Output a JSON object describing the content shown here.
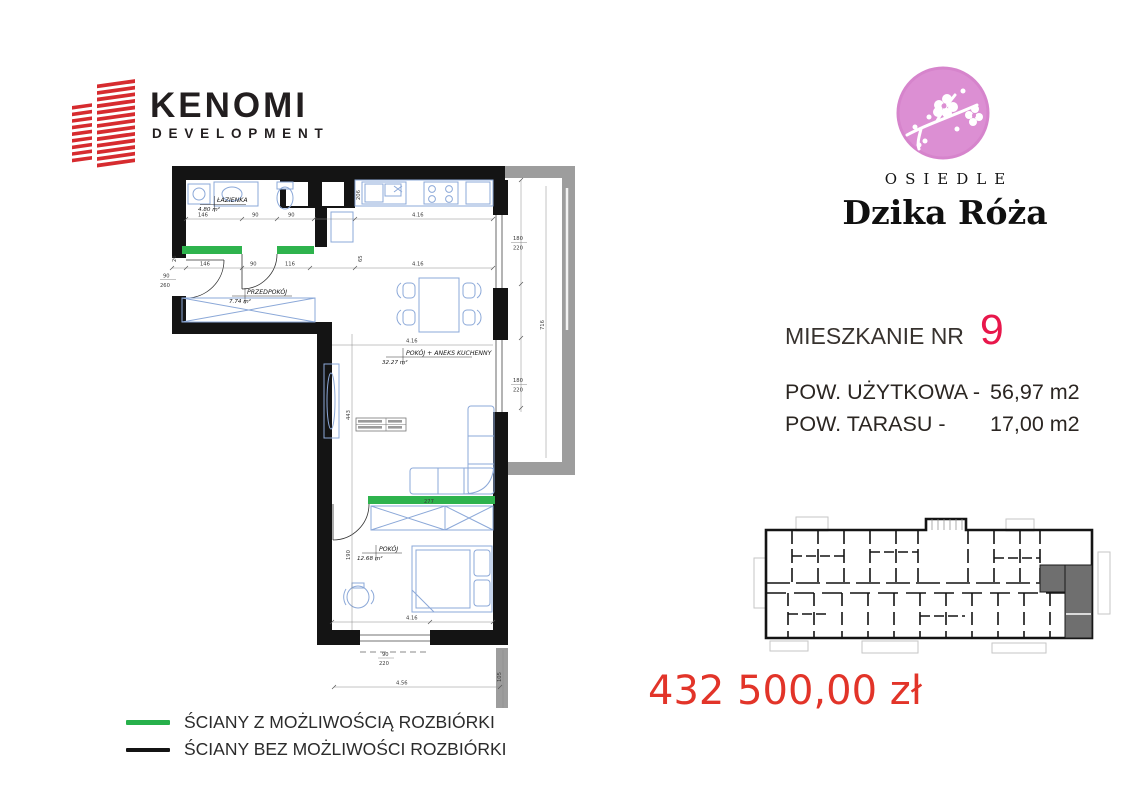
{
  "brand": {
    "name": "KENOMI",
    "subtitle": "DEVELOPMENT"
  },
  "estate": {
    "label": "OSIEDLE",
    "name": "Dzika Róża"
  },
  "apartment": {
    "label": "MIESZKANIE NR",
    "number": "9",
    "specs": [
      {
        "label": "POW. UŻYTKOWA  -",
        "value": "56,97 m2"
      },
      {
        "label": "POW. TARASU  -",
        "value": "17,00 m2"
      }
    ]
  },
  "price": {
    "amount": "432 500,00 zł"
  },
  "legend": {
    "items": [
      {
        "label": "ŚCIANY Z MOŻLIWOŚCIĄ ROZBIÓRKI",
        "color": "#27b04b"
      },
      {
        "label": "ŚCIANY BEZ MOŻLIWOŚCI ROZBIÓRKI",
        "color": "#141414"
      }
    ]
  },
  "plan": {
    "rooms": [
      {
        "name": "ŁAZIENKA",
        "area": "4.80 m²"
      },
      {
        "name": "PRZEDPOKÓJ",
        "area": "7.74 m²"
      },
      {
        "name": "POKÓJ + ANEKS KUCHENNY",
        "area": "32.27 m²"
      },
      {
        "name": "POKÓJ",
        "area": "12.68 m²"
      }
    ],
    "dims": [
      "146",
      "90",
      "90",
      "4.16",
      "206",
      "146",
      "90",
      "116",
      "4.16",
      "65",
      "4.16",
      "443",
      "277",
      "4.16",
      "190",
      "180",
      "220",
      "180",
      "220",
      "716",
      "4.56",
      "105",
      "90",
      "220",
      "26",
      "90",
      "260"
    ]
  },
  "colors": {
    "brand_red": "#d62b2f",
    "estate_pink": "#dc8fd3",
    "apartment_number_red": "#e8174b",
    "price_red": "#e23429",
    "legend_green": "#27b04b",
    "wall_black": "#141414",
    "terrace_gray": "#9d9d9d",
    "highlight_unit_gray": "#6f6f6f",
    "furniture_blue": "#8ba8d8"
  }
}
